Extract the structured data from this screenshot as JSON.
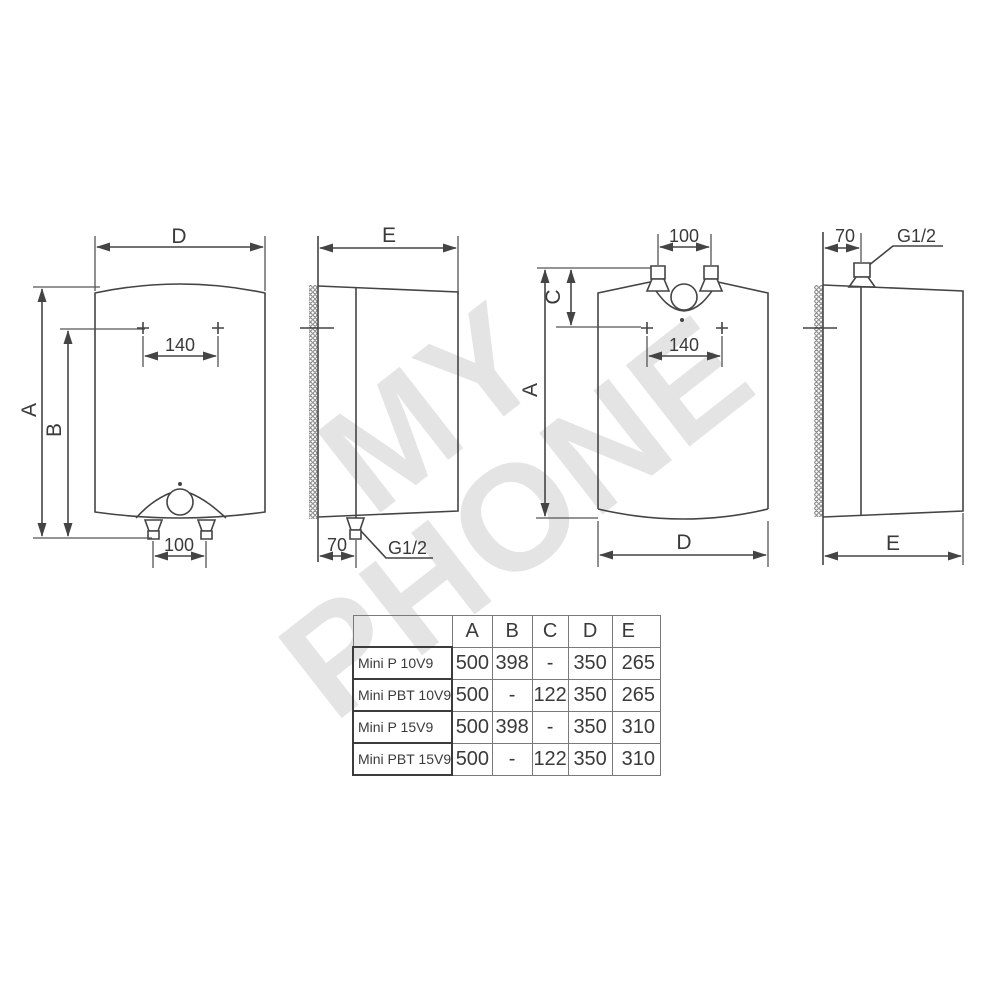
{
  "watermark": {
    "line1": "MY",
    "line2": "PHONE"
  },
  "labels": {
    "d1": {
      "width": "D",
      "height": "A",
      "inner_height": "B",
      "holes": "140",
      "pipes": "100"
    },
    "d2": {
      "depth": "E",
      "offset": "70",
      "thread": "G1/2"
    },
    "d3": {
      "pipes": "100",
      "top_offset": "C",
      "height": "A",
      "holes": "140",
      "width": "D"
    },
    "d4": {
      "offset": "70",
      "thread": "G1/2",
      "depth": "E"
    }
  },
  "table": {
    "columns": [
      "A",
      "B",
      "C",
      "D",
      "E"
    ],
    "rows": [
      {
        "model": "Mini P 10V9",
        "A": "500",
        "B": "398",
        "C": "-",
        "D": "350",
        "E": "265"
      },
      {
        "model": "Mini PBT 10V9",
        "A": "500",
        "B": "-",
        "C": "122",
        "D": "350",
        "E": "265"
      },
      {
        "model": "Mini P 15V9",
        "A": "500",
        "B": "398",
        "C": "-",
        "D": "350",
        "E": "310"
      },
      {
        "model": "Mini PBT 15V9",
        "A": "500",
        "B": "-",
        "C": "122",
        "D": "350",
        "E": "310"
      }
    ]
  }
}
